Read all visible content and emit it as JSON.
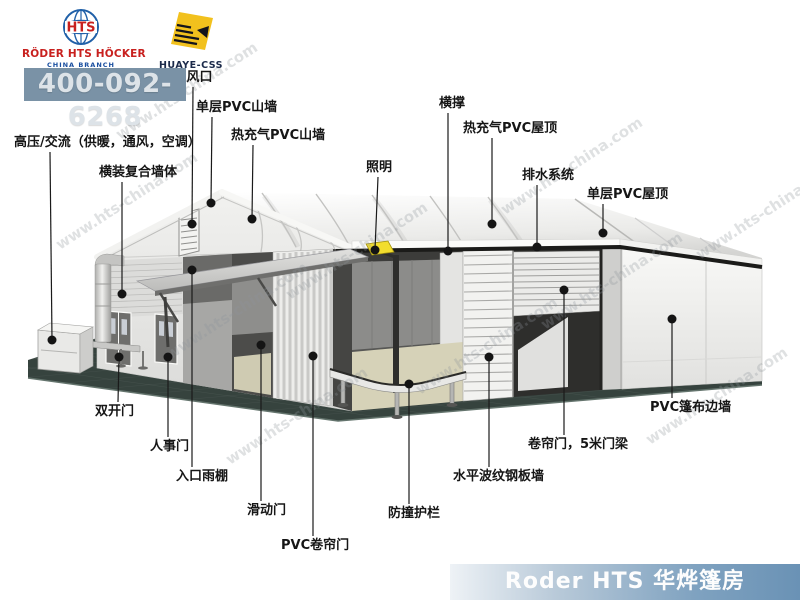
{
  "header": {
    "roder_logo": {
      "badge": "HTS",
      "title": "RÖDER HTS HÖCKER",
      "subtitle": "CHINA BRANCH"
    },
    "huaye_logo": {
      "title": "HUAYE-CSS"
    },
    "phone": "400-092-6268"
  },
  "diagram": {
    "watermark": "www.hts-china.com",
    "dot_color": "#141414",
    "line_color": "#1a1a1a",
    "callouts": [
      {
        "label": "通风口",
        "tx": 193,
        "ty": 81,
        "anchor": "middle",
        "x1": 193,
        "y1": 87,
        "x2": 192,
        "y2": 224
      },
      {
        "label": "单层PVC山墙",
        "tx": 196,
        "ty": 111,
        "anchor": "start",
        "x1": 212,
        "y1": 117,
        "x2": 211,
        "y2": 203
      },
      {
        "label": "热充气PVC山墙",
        "tx": 231,
        "ty": 139,
        "anchor": "start",
        "x1": 253,
        "y1": 145,
        "x2": 252,
        "y2": 219
      },
      {
        "label": "高压/交流（供暖，通风，空调）",
        "tx": 14,
        "ty": 146,
        "anchor": "start",
        "x1": 50,
        "y1": 152,
        "x2": 52,
        "y2": 340
      },
      {
        "label": "横装复合墙体",
        "tx": 99,
        "ty": 176,
        "anchor": "start",
        "x1": 122,
        "y1": 182,
        "x2": 122,
        "y2": 294
      },
      {
        "label": "照明",
        "tx": 379,
        "ty": 171,
        "anchor": "middle",
        "x1": 378,
        "y1": 177,
        "x2": 375,
        "y2": 250
      },
      {
        "label": "横撑",
        "tx": 452,
        "ty": 107,
        "anchor": "middle",
        "x1": 448,
        "y1": 113,
        "x2": 448,
        "y2": 251
      },
      {
        "label": "热充气PVC屋顶",
        "tx": 463,
        "ty": 132,
        "anchor": "start",
        "x1": 492,
        "y1": 138,
        "x2": 492,
        "y2": 224
      },
      {
        "label": "排水系统",
        "tx": 522,
        "ty": 179,
        "anchor": "start",
        "x1": 537,
        "y1": 185,
        "x2": 537,
        "y2": 247
      },
      {
        "label": "单层PVC屋顶",
        "tx": 587,
        "ty": 198,
        "anchor": "start",
        "x1": 603,
        "y1": 204,
        "x2": 603,
        "y2": 233
      },
      {
        "label": "双开门",
        "tx": 95,
        "ty": 415,
        "anchor": "start",
        "x1": 118,
        "y1": 402,
        "x2": 119,
        "y2": 357
      },
      {
        "label": "人事门",
        "tx": 150,
        "ty": 450,
        "anchor": "start",
        "x1": 168,
        "y1": 437,
        "x2": 168,
        "y2": 357
      },
      {
        "label": "入口雨棚",
        "tx": 176,
        "ty": 480,
        "anchor": "start",
        "x1": 192,
        "y1": 467,
        "x2": 192,
        "y2": 270
      },
      {
        "label": "滑动门",
        "tx": 247,
        "ty": 514,
        "anchor": "start",
        "x1": 261,
        "y1": 501,
        "x2": 261,
        "y2": 345
      },
      {
        "label": "PVC卷帘门",
        "tx": 281,
        "ty": 549,
        "anchor": "start",
        "x1": 313,
        "y1": 536,
        "x2": 313,
        "y2": 356
      },
      {
        "label": "防撞护栏",
        "tx": 388,
        "ty": 517,
        "anchor": "start",
        "x1": 409,
        "y1": 504,
        "x2": 409,
        "y2": 384
      },
      {
        "label": "水平波纹钢板墙",
        "tx": 453,
        "ty": 480,
        "anchor": "start",
        "x1": 489,
        "y1": 467,
        "x2": 489,
        "y2": 357
      },
      {
        "label": "卷帘门，5米门梁",
        "tx": 528,
        "ty": 448,
        "anchor": "start",
        "x1": 564,
        "y1": 435,
        "x2": 564,
        "y2": 290
      },
      {
        "label": "PVC篷布边墙",
        "tx": 650,
        "ty": 411,
        "anchor": "start",
        "x1": 672,
        "y1": 398,
        "x2": 672,
        "y2": 319
      }
    ]
  },
  "footer": {
    "banner": "Roder HTS 华烨篷房",
    "accent_color": "#7fa2c0"
  }
}
